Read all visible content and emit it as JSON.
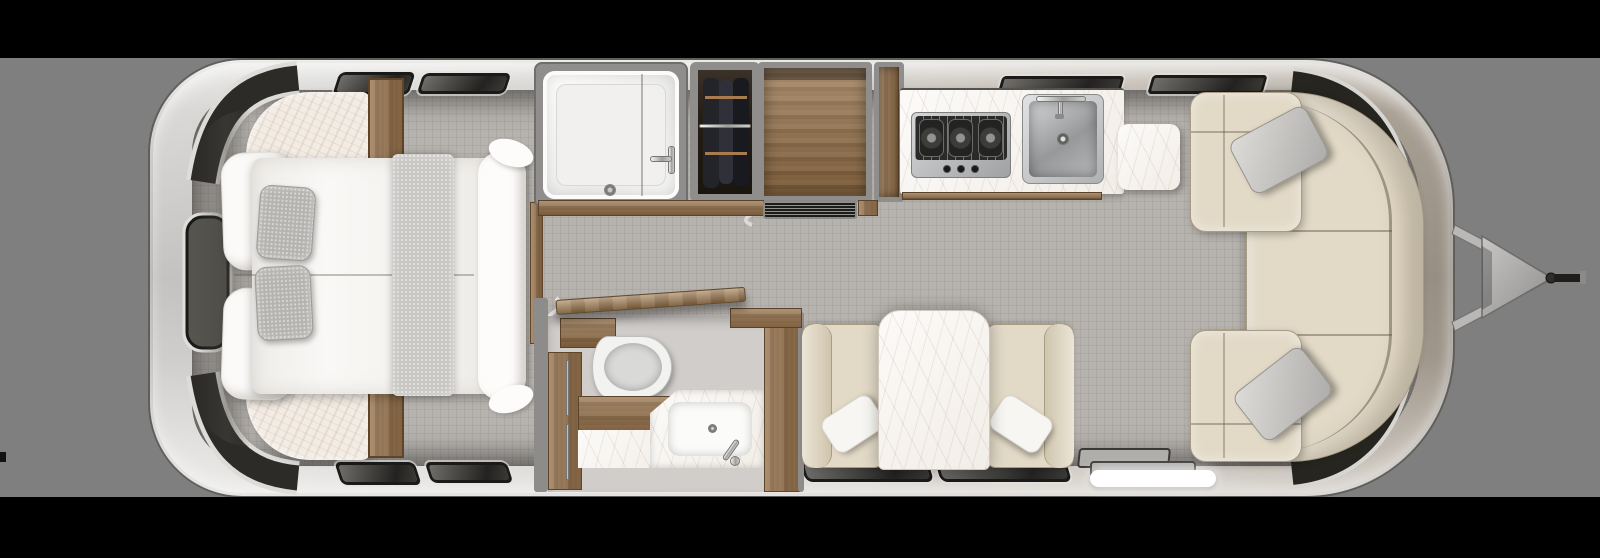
{
  "meta": {
    "title": "Travel trailer floor plan — overhead 3D render, hitch facing right",
    "render_style": "photoreal top-down cutaway",
    "text_content": "none — the image contains no visible text"
  },
  "layout": {
    "canvas": {
      "width": 1600,
      "height": 558
    },
    "letterbox_bar_color": "#000000",
    "backdrop_color": "#7f7f7f",
    "shell": {
      "x": 148,
      "y": 58,
      "width": 1307,
      "height": 440
    }
  },
  "palette": {
    "shell_rear_silver": "#d6d4d1",
    "shell_front_taupe": "#a89f93",
    "floor_tile": "#b6b2ae",
    "interior_wall_gray": "#8d8c8a",
    "wood_cabinetry": "#8a6741",
    "marble_surface": "#f6f3ee",
    "upholstery_beige": "#e2d9c6",
    "pillow_gray": "#b6b4b1",
    "linen_white": "#fbfaf8",
    "window_glass_dark": "#3a3936",
    "chrome": "#d9d9d7"
  },
  "rooms": {
    "bedroom": {
      "label": "Rear bedroom — queen bed, white duvet, 2 white pillows, 2 gray accent pillows, gray throw runner, upholstered corner bolsters, flanking wood wardrobes"
    },
    "shower": {
      "label": "Shower stall with glass door, chrome valve and floor drain"
    },
    "wardrobe": {
      "label": "Wardrobe closet with hanging rod and clothing"
    },
    "cabinet": {
      "label": "Wood cabinetry / refrigerator with vent grille below"
    },
    "galley": {
      "label": "Galley — marble counter, 3-burner gas cooktop, stainless sink, marble counter extension"
    },
    "bathroom": {
      "label": "Bathroom — toilet, wood vanity with towel bars, corner marble sink, open wood door"
    },
    "dinette": {
      "label": "Dinette — two facing bench seats with white pillows and a marble-top table"
    },
    "lounge": {
      "label": "Front lounge — wraparound L-sofa with two gray throw pillows"
    },
    "entry": {
      "label": "Entry — fold-out step treads with illuminated white threshold"
    },
    "hitch": {
      "label": "A-frame tongue with propane cover plate and coupler"
    }
  },
  "fixtures": {
    "cooktop_burners": 3,
    "cooktop_knobs": 3,
    "sink_basins": 1,
    "bed_gray_pillows": 2,
    "bed_white_pillows": 2,
    "sofa_throw_pillows": 2,
    "dinette_pillows": 2,
    "entry_step_treads": 2
  },
  "windows": {
    "rear_wraparound_windows": 3,
    "front_wraparound_windows": 3,
    "roof_vents_top": 2,
    "roof_vents_bottom": 2,
    "galley_awning_windows": 2,
    "dinette_windows": 2
  }
}
